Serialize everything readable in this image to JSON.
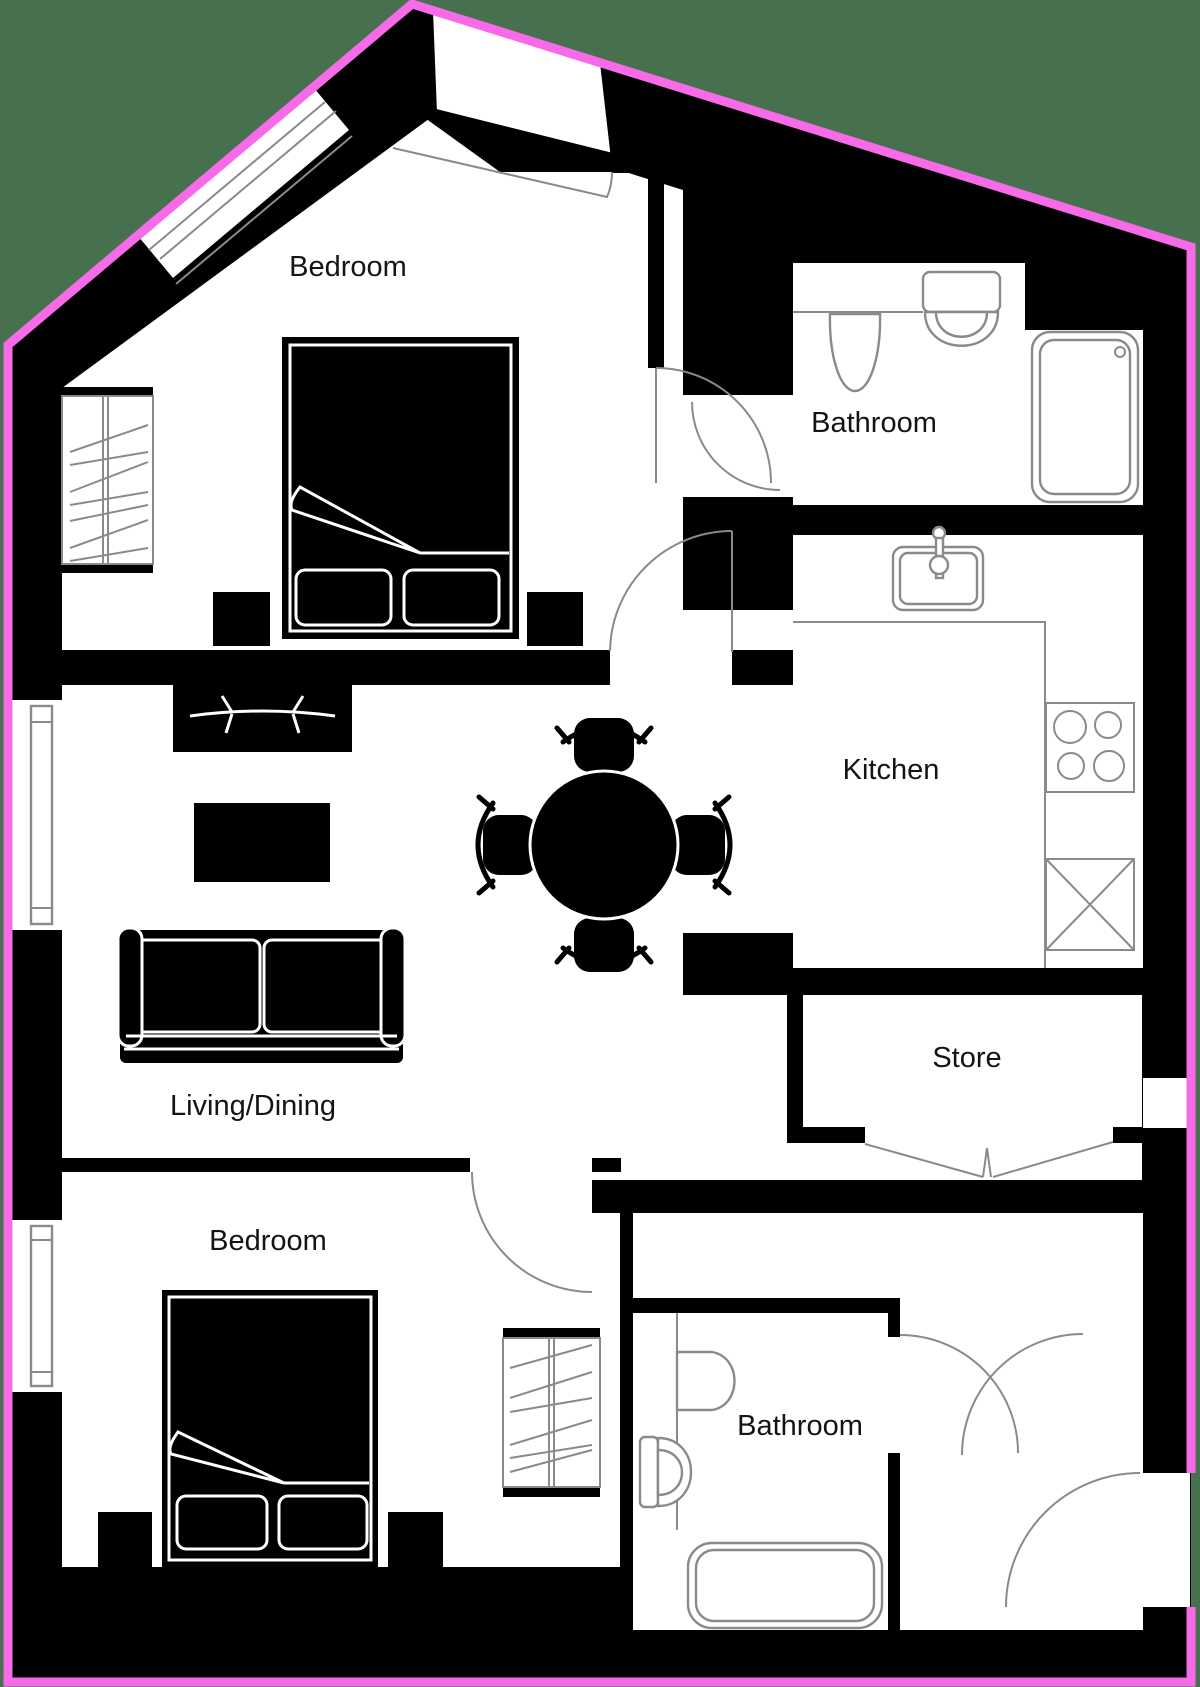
{
  "title": "Apartment floor plan",
  "rooms": [
    {
      "id": "bedroom-top",
      "label": "Bedroom"
    },
    {
      "id": "bathroom-top",
      "label": "Bathroom"
    },
    {
      "id": "kitchen",
      "label": "Kitchen"
    },
    {
      "id": "store",
      "label": "Store"
    },
    {
      "id": "living-dining",
      "label": "Living/Dining"
    },
    {
      "id": "bedroom-bottom",
      "label": "Bedroom"
    },
    {
      "id": "bathroom-bottom",
      "label": "Bathroom"
    }
  ],
  "colors": {
    "outline_pink": "#f76ae8",
    "background_green": "#47714e",
    "wall_black": "#000000",
    "floor_white": "#ffffff",
    "fixture_line_gray": "#8a8a8a",
    "label_text": "#141414"
  },
  "fixtures": [
    "double-bed-top",
    "wardrobe-top",
    "nightstands-top",
    "tv-unit",
    "coffee-table",
    "sofa",
    "round-dining-table",
    "dining-chairs",
    "kitchen-sink",
    "hob-4-rings",
    "appliance-box",
    "pedestal-sink-top",
    "toilet-top",
    "bathtub-top",
    "store-bifold-doors",
    "double-bed-bottom",
    "wardrobe-bottom",
    "nightstands-bottom",
    "basin-bottom",
    "toilet-bottom",
    "bathtub-bottom",
    "entrance-door"
  ]
}
